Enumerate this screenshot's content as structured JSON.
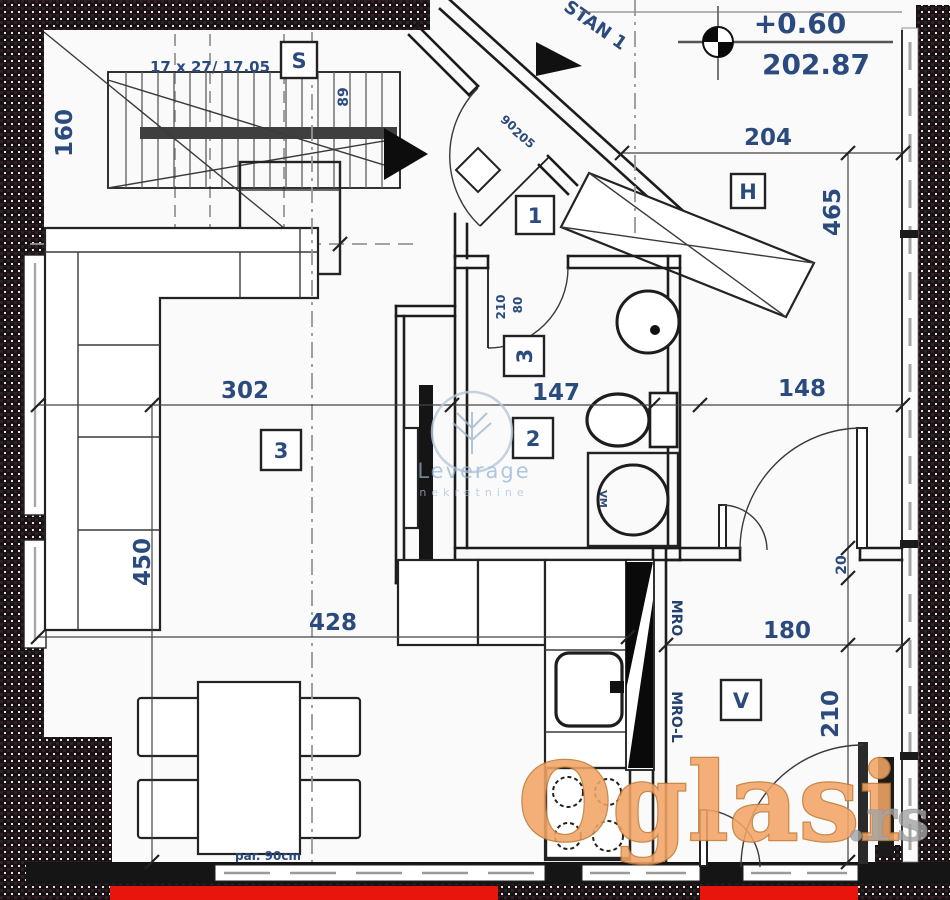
{
  "apartment": {
    "name": "STAN 1"
  },
  "level_marker": {
    "relative": "+0.60",
    "absolute": "202.87"
  },
  "stairs": {
    "tag": "S",
    "formula": "17 x 27/ 17.05",
    "width": "89",
    "side_dim": "160"
  },
  "dims": {
    "hall_width": "204",
    "hall_length": "465",
    "living_width": "302",
    "bath_width": "147",
    "right_width": "148",
    "living_depth": "450",
    "living_full_width": "428",
    "door_gap": "20",
    "room_v_width": "180",
    "room_v_depth": "210"
  },
  "doors": {
    "bath_width": "80",
    "bath_height": "210",
    "entry_width": "90",
    "entry_height": "205"
  },
  "tags": {
    "entry": "1",
    "bathroom": "2",
    "living": "3",
    "bath_upper": "3",
    "hallway": "H",
    "room_v": "V"
  },
  "annotations": {
    "parapet": "par. 90cm",
    "duct_upper": "MRO",
    "duct_lower": "MRO-L",
    "washer": "VM"
  },
  "watermarks": {
    "agency": "Leverage",
    "agency_sub": "nekretnine",
    "portal": "Oglasi",
    "portal_tld": ".rs"
  },
  "colors": {
    "dimension_text": "#2b4a7e",
    "wall": "#1c1c1c",
    "highlight_red": "#e8150c",
    "portal_orange": "#f2a566",
    "agency_blue": "#8fb3d3"
  }
}
